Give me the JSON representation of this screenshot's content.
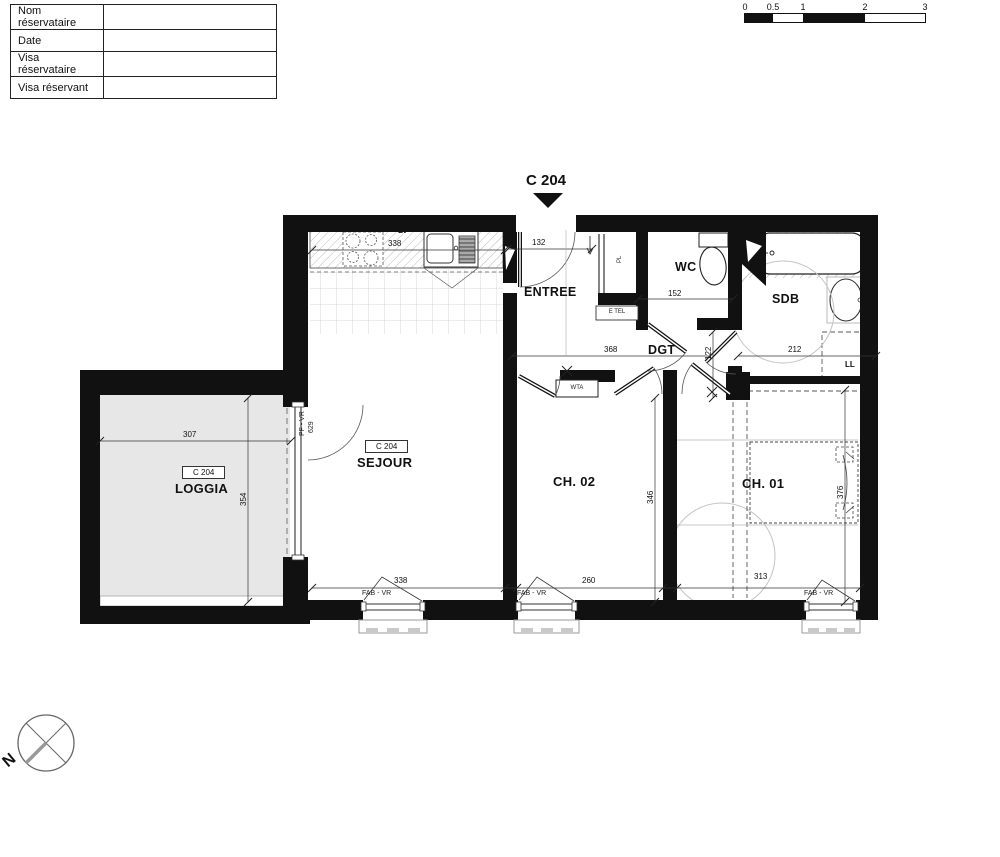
{
  "reservation_table": {
    "rows": [
      {
        "label": "Nom réservataire",
        "value": ""
      },
      {
        "label": "Date",
        "value": ""
      },
      {
        "label": "Visa réservataire",
        "value": ""
      },
      {
        "label": "Visa réservant",
        "value": ""
      }
    ]
  },
  "scale_bar": {
    "ticks": [
      "0",
      "0.5",
      "1",
      "2",
      "3"
    ]
  },
  "title": {
    "unit": "C 204"
  },
  "rooms": {
    "loggia": {
      "label": "LOGGIA",
      "tag": "C 204",
      "width": "307",
      "depth": "354"
    },
    "sejour": {
      "label": "SEJOUR",
      "tag": "C 204",
      "width": "338"
    },
    "kitchen": {
      "counter_width": "338",
      "dishwasher": "LV"
    },
    "entree": {
      "label": "ENTREE",
      "door_width": "132"
    },
    "wc": {
      "label": "WC",
      "width": "152"
    },
    "sdb": {
      "label": "SDB",
      "width": "212",
      "washer": "LL"
    },
    "dgt": {
      "label": "DGT",
      "width": "368",
      "clearance": "122"
    },
    "ch02": {
      "label": "CH. 02",
      "width": "260",
      "depth": "346"
    },
    "ch01": {
      "label": "CH. 01",
      "width": "313",
      "depth": "376"
    }
  },
  "fixtures": {
    "closet": "PL",
    "telecom": "E TEL",
    "panel": "WTA"
  },
  "windows": {
    "french_window": "PF - VR",
    "french_window_dim": "629",
    "window": "FAB - VR"
  },
  "compass": {
    "north": "N"
  }
}
